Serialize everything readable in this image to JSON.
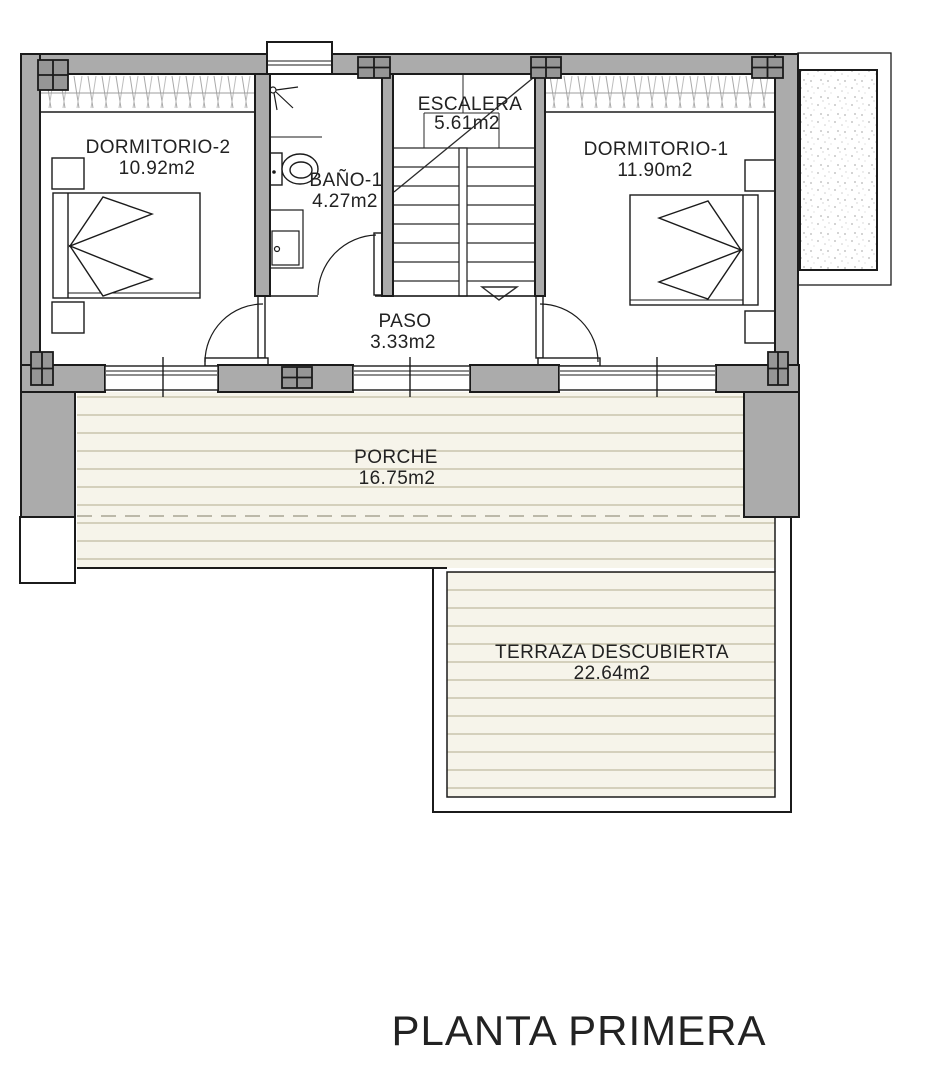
{
  "plan": {
    "title": "PLANTA PRIMERA",
    "rooms": [
      {
        "id": "dormitorio-2",
        "name": "DORMITORIO-2",
        "area": "10.92m2"
      },
      {
        "id": "bano-1",
        "name": "BAÑO-1",
        "area": "4.27m2"
      },
      {
        "id": "escalera",
        "name": "ESCALERA",
        "area": "5.61m2"
      },
      {
        "id": "dormitorio-1",
        "name": "DORMITORIO-1",
        "area": "11.90m2"
      },
      {
        "id": "paso",
        "name": "PASO",
        "area": "3.33m2"
      },
      {
        "id": "porche",
        "name": "PORCHE",
        "area": "16.75m2"
      },
      {
        "id": "terraza",
        "name": "TERRAZA DESCUBIERTA",
        "area": "22.64m2"
      }
    ],
    "colors": {
      "wall": "#ababab",
      "column": "#969696",
      "line": "#1b1b1b",
      "deck_bg": "#f6f4ea",
      "deck_line": "#c8c4ac",
      "hatch_line": "#a8a8a8",
      "text": "#222222",
      "paper": "#ffffff"
    }
  }
}
